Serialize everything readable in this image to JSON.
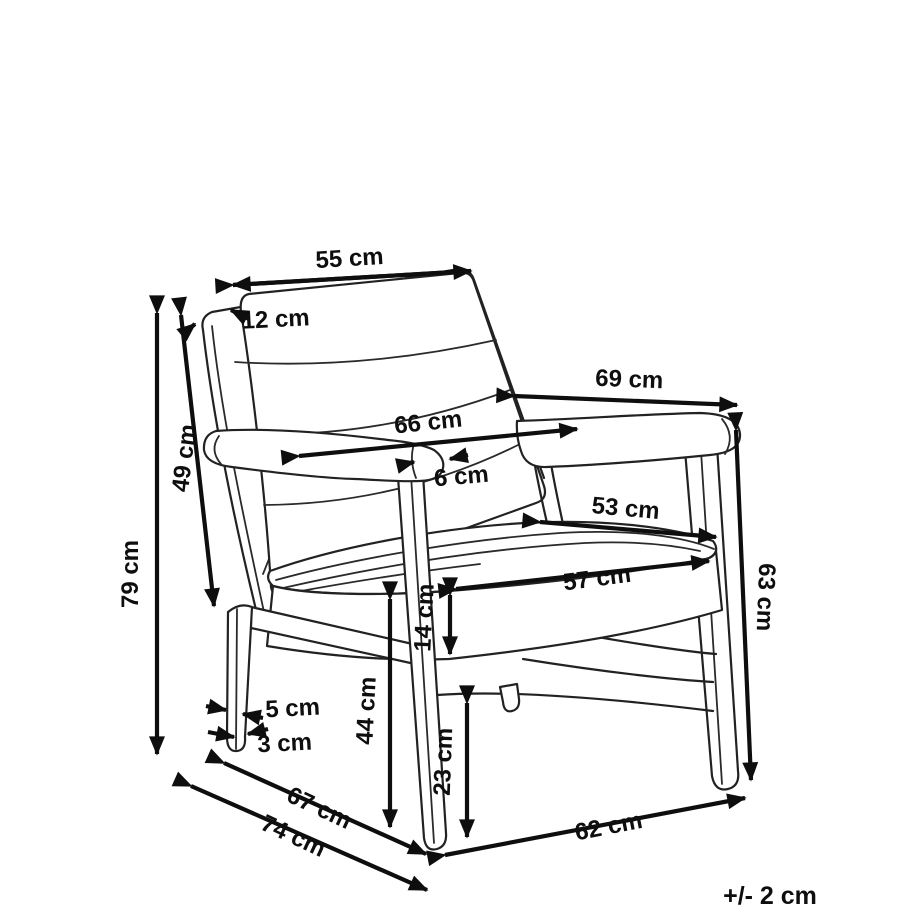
{
  "diagram": {
    "type": "product-dimension-drawing",
    "subject": "armchair three-quarter line drawing with dimension arrows",
    "unit": "cm",
    "tolerance_note": "+/- 2 cm",
    "dimensions": [
      {
        "id": "overall-height",
        "label": "79 cm",
        "value": 79
      },
      {
        "id": "backrest-height",
        "label": "49 cm",
        "value": 49
      },
      {
        "id": "backrest-width",
        "label": "55 cm",
        "value": 55
      },
      {
        "id": "backrest-thickness",
        "label": "12 cm",
        "value": 12
      },
      {
        "id": "armrest-length",
        "label": "69 cm",
        "value": 69
      },
      {
        "id": "width-between-armrests",
        "label": "66 cm",
        "value": 66
      },
      {
        "id": "armrest-width",
        "label": "6 cm",
        "value": 6
      },
      {
        "id": "seat-back-width",
        "label": "53 cm",
        "value": 53
      },
      {
        "id": "seat-front-width",
        "label": "57 cm",
        "value": 57
      },
      {
        "id": "seat-cushion-thickness",
        "label": "14 cm",
        "value": 14
      },
      {
        "id": "armrest-height",
        "label": "63 cm",
        "value": 63
      },
      {
        "id": "seat-height",
        "label": "44 cm",
        "value": 44
      },
      {
        "id": "leg-top-width",
        "label": "5 cm",
        "value": 5
      },
      {
        "id": "leg-bottom-width",
        "label": "3 cm",
        "value": 3
      },
      {
        "id": "under-seat-clearance",
        "label": "23 cm",
        "value": 23
      },
      {
        "id": "seat-depth",
        "label": "67 cm",
        "value": 67
      },
      {
        "id": "overall-depth",
        "label": "74 cm",
        "value": 74
      },
      {
        "id": "base-front-width",
        "label": "62 cm",
        "value": 62
      }
    ]
  }
}
